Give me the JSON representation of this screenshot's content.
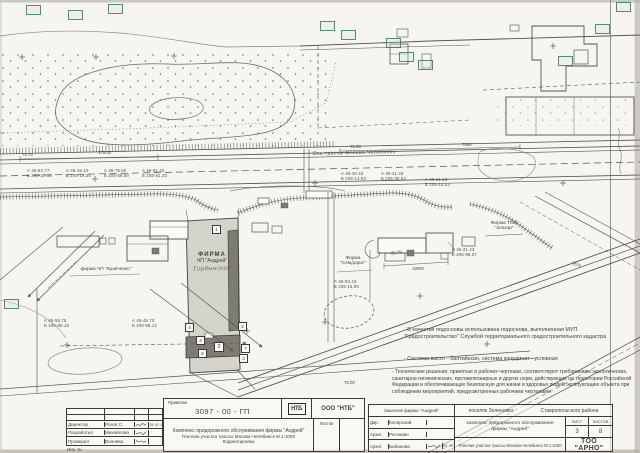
{
  "colors": {
    "paper": "#f6f5f0",
    "ink": "#44423d",
    "ink_light": "#8a877e",
    "green_marker": "#2f7c67",
    "parcel_fill": "#d4d3cc",
    "building_fill": "#7d7b74"
  },
  "plan": {
    "road_axis_label": "Ось трассы Москва-Челябинск",
    "firma_andrey_line1": "ФИРМА",
    "firma_andrey_line2": "ЧП \"Андрей\"",
    "firma_andrey_hand": "Гордынский",
    "firma_kravchenko": "фирма ЧП \"Кравченко\"",
    "firma_semdoris_line1": "Фирма",
    "firma_semdoris_line2": "\"Семдорис\"",
    "firma_zlatar_line1": "Фирма ТОО",
    "firma_zlatar_line2": "\"Златар\""
  },
  "survey_points": [
    {
      "a": "А 45-64.77",
      "b": "Б 205-20.10"
    },
    {
      "a": "А 45-16.10",
      "b": "Б 205-19.30"
    },
    {
      "a": "А 45-76.50",
      "b": "Б 205-59.50"
    },
    {
      "a": "А 45-91.40",
      "b": "Б 205-81.20"
    },
    {
      "a": "А 45-30.43",
      "b": "Б 205-13.92"
    },
    {
      "a": "А 45-41.33",
      "b": "Б 205-30.92"
    },
    {
      "a": "А 45-21.13",
      "b": "Б 205-14.53"
    },
    {
      "a": "А 45-21.43",
      "b": "Б 206-98.07"
    },
    {
      "a": "А 45-93.43",
      "b": "Б 205-15.90"
    },
    {
      "a": "А 45-55.75",
      "b": "Б 206-80.19"
    },
    {
      "a": "А 45-46.70",
      "b": "Б 206-58.12"
    }
  ],
  "dimensions": [
    {
      "value": "74.75"
    },
    {
      "value": "175.00"
    },
    {
      "value": "75.00"
    },
    {
      "value": "7500"
    },
    {
      "value": "18000"
    },
    {
      "value": "25.79"
    },
    {
      "value": "9670"
    },
    {
      "value": "75.00"
    }
  ],
  "markers": [
    {
      "n": "1"
    },
    {
      "n": "4"
    },
    {
      "n": "4"
    },
    {
      "n": "5"
    },
    {
      "n": "2"
    },
    {
      "n": "7"
    },
    {
      "n": "4"
    },
    {
      "n": "2"
    }
  ],
  "notes": {
    "items": [
      "- В качестве подосновы использована подоснова, выполненная МУП \"Градостроительство\" Службой территориального градостроительного кадастра",
      "- Система высот - балтийская, система координат - условная",
      "- Технические решения, принятые в рабочих чертежах, соответствуют требованиям экологических, санитарно-гигиенических, противопожарных и других норм, действующих на территории Российской Федерации и обеспечивающих безопасную для жизни и здоровья людей эксплуатацию объекта при соблюдении мероприятий, предусмотренных рабочими чертежами"
    ]
  },
  "titleblock": {
    "stamp_label": "Привязан",
    "doc_number": "3097 - 00 - ГП",
    "org_logo": "НТБ",
    "org_name": "ООО \"НТБ\"",
    "left_rows": [
      {
        "role": "Директор",
        "name": "Розов С.",
        "date": "18.02.95"
      },
      {
        "role": "Разработал",
        "name": "Михайлова",
        "date": ""
      },
      {
        "role": "Проверил",
        "name": "Волнева",
        "date": ""
      }
    ],
    "inv_label": "Инв. №",
    "project_line1": "Комплекс придорожного обслуживания фирмы \"Андрей\"",
    "project_line2": "Генплан участка трассы Москва-Челябинск М 1:1000",
    "project_line3": "Корректировка",
    "listov_mid_label": "Листов",
    "customer_label": "Заказчик  фирма \"Андрей\"",
    "location": "поселок Зеленовка",
    "district": "Ставропольского района",
    "right_rows": [
      {
        "role": "Дир.",
        "name": "Копорский",
        "date": ""
      },
      {
        "role": "Архит.",
        "name": "Рогожкин",
        "date": ""
      },
      {
        "role": "Архит.",
        "name": "Бабинова",
        "date": "05.95"
      }
    ],
    "complex_title": "комплекс придорожного обслуживания фирмы \"Андрей\"",
    "sheet_label": "ЛИСТ",
    "sheets_label": "ЛИСТОВ",
    "sheet_no": "3",
    "sheets_total": "8",
    "drawing_title": "Генплан участка трассы Москва-Челябинск М 1:1000",
    "company": "ТОО \"АРНО\""
  }
}
